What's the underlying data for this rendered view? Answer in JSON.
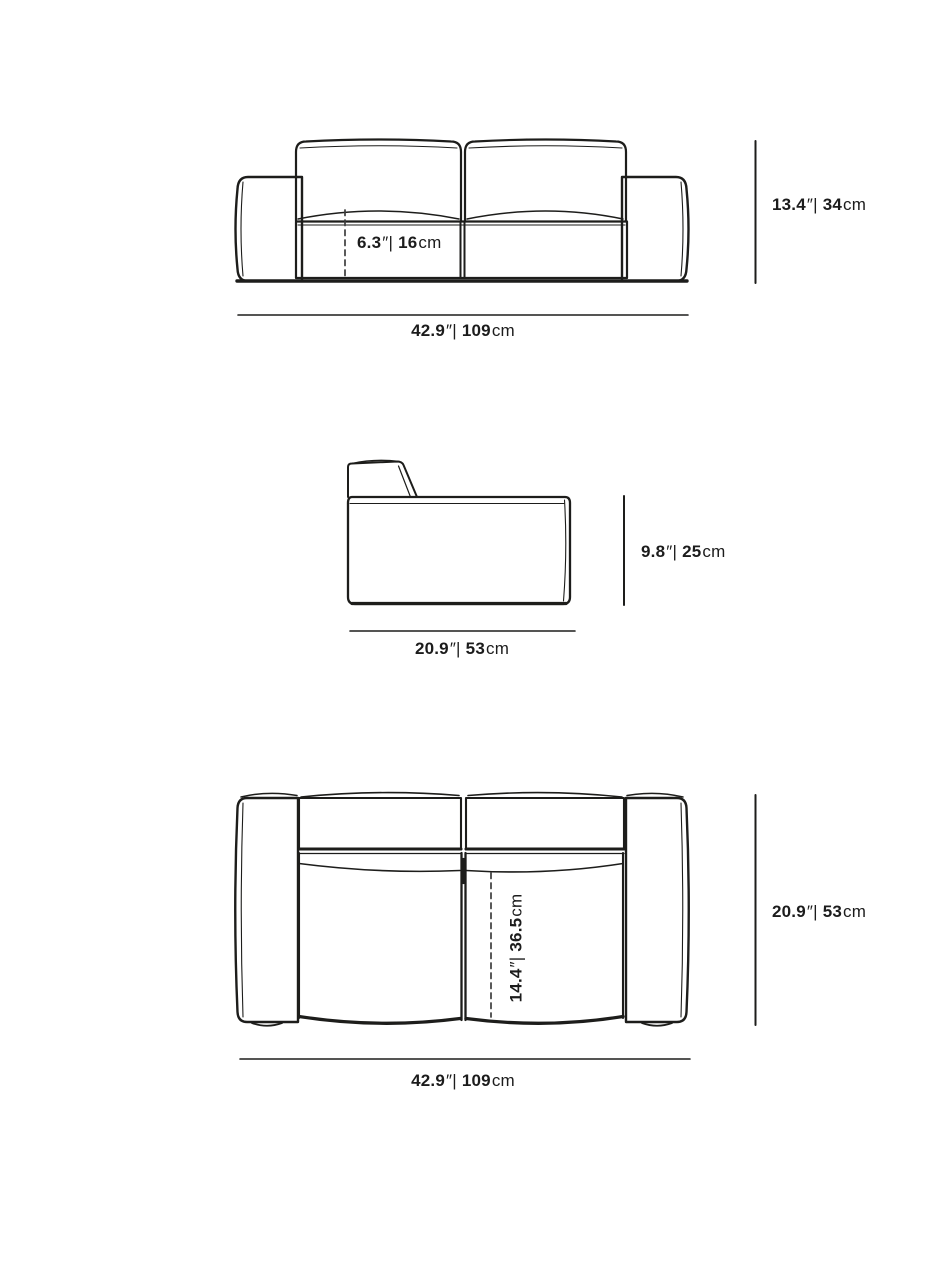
{
  "diagram": {
    "subject": "loveseat-dimension-drawing",
    "units": {
      "inch_sep": "″|",
      "cm": "cm"
    },
    "views": {
      "front": {
        "seat_height": {
          "in": "6.3",
          "cm": "16"
        },
        "overall_height": {
          "in": "13.4",
          "cm": "34"
        },
        "overall_width": {
          "in": "42.9",
          "cm": "109"
        }
      },
      "side": {
        "seat_height": {
          "in": "9.8",
          "cm": "25"
        },
        "depth": {
          "in": "20.9",
          "cm": "53"
        }
      },
      "top": {
        "seat_depth": {
          "in": "14.4",
          "cm": "36.5"
        },
        "overall_depth": {
          "in": "20.9",
          "cm": "53"
        },
        "overall_width": {
          "in": "42.9",
          "cm": "109"
        }
      }
    },
    "colors": {
      "line": "#1d1d1b",
      "dash": "#3c3c3c",
      "text": "#1c1c1c",
      "background": "#ffffff"
    }
  }
}
